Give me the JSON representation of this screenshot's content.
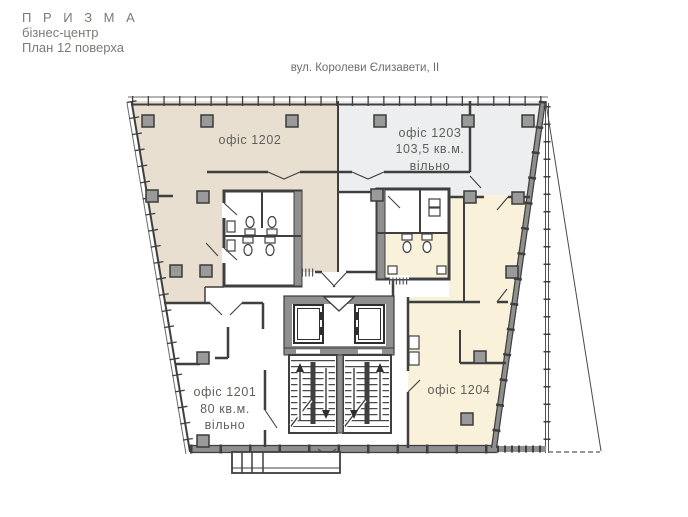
{
  "header": {
    "brand": "П Р И З М А",
    "type": "бізнес-центр",
    "plan": "План 12 поверха"
  },
  "street_label": "вул. Королеви Єлизавети, II",
  "offices": [
    {
      "id": "1202",
      "name": "офіс 1202",
      "color": "#e9dfd0"
    },
    {
      "id": "1203",
      "name": "офіс 1203",
      "area": "103,5 кв.м.",
      "status": "вільно",
      "color": "#edeef0"
    },
    {
      "id": "1201",
      "name": "офіс 1201",
      "area": "80 кв.м.",
      "status": "вільно",
      "color": "#ffffff"
    },
    {
      "id": "1204",
      "name": "офіс 1204",
      "color": "#f9f1d9"
    }
  ],
  "colors": {
    "wall": "#3f3f3f",
    "wall_fill": "#8f8f8f",
    "column_fill": "#9a9a9a",
    "office_1202": "#e9dfd0",
    "office_1203": "#edeef0",
    "office_1204": "#f9f1d9",
    "text": "#5f5f5a"
  }
}
